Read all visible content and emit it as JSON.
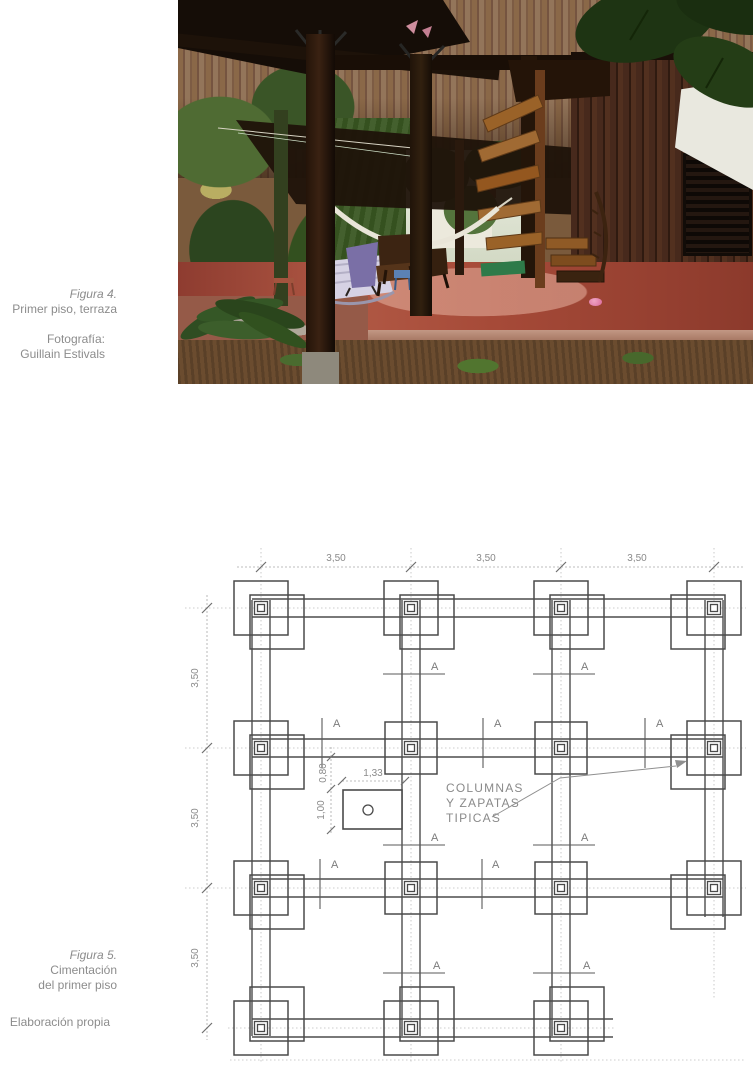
{
  "figure4": {
    "title": "Figura 4.",
    "caption": "Primer piso, terraza",
    "credit_label": "Fotografía:",
    "credit_name": "Guillain Estivals"
  },
  "figure5": {
    "title": "Figura 5.",
    "caption_line1": "Cimentación",
    "caption_line2": "del primer piso",
    "credit": "Elaboración propia"
  },
  "plan": {
    "dims_top": [
      "3,50",
      "3,50",
      "3,50"
    ],
    "dims_left": [
      "3,50",
      "3,50",
      "3,50"
    ],
    "detail_dims": {
      "width": "1,33",
      "height": "1,00",
      "offset": "0,80"
    },
    "annotation": {
      "line1": "COLUMNAS",
      "line2": "Y ZAPATAS",
      "line3": "TIPICAS"
    },
    "section_labels": [
      "A",
      "A",
      "A",
      "A",
      "A",
      "A",
      "A",
      "A",
      "A",
      "A",
      "A"
    ],
    "colors": {
      "line": "#4d4d4d",
      "centerline": "#bcbcbc",
      "text": "#8a8a8a"
    }
  },
  "photo": {
    "palette": {
      "upper_wood": "#8a6848",
      "dark_structure": "#1b110a",
      "right_wall": "#3a231a",
      "foliage": "#3a5527",
      "floor_terracotta": "#a64a38",
      "soil": "#6b4c2f",
      "hammock": "#e9e5d8",
      "stairs_wood": "#9a6228",
      "awning": "#e9e8df",
      "pink_bowl": "#d9699b",
      "green_mat": "#2e7a49",
      "purple_chair": "#7a6fa6"
    }
  }
}
